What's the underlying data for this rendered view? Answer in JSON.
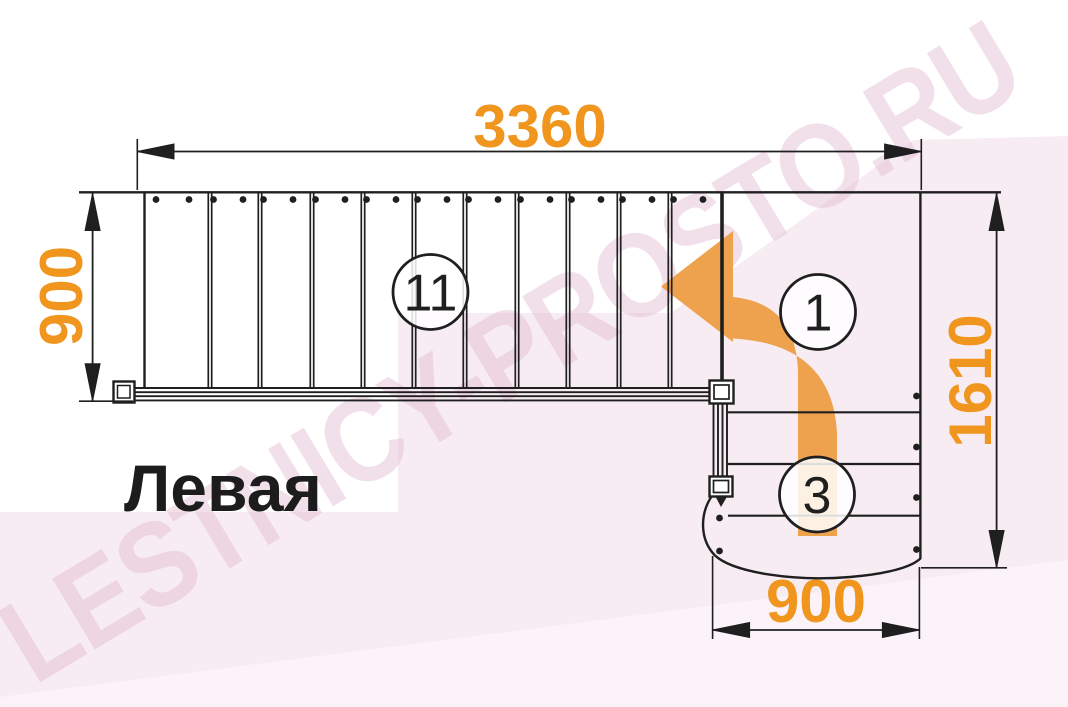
{
  "page": {
    "type_label": "Левая",
    "watermark": "LESTNICY-PROSTO.RU"
  },
  "dimensions": {
    "total_length_mm": "3360",
    "upper_flight_width_mm": "900",
    "total_depth_mm": "1610",
    "lower_flight_width_mm": "900"
  },
  "flight_markers": {
    "upper_steps": "11",
    "turn_step": "1",
    "lower_steps": "3"
  },
  "structure": {
    "upper_tread_count": 11,
    "lower_step_line_count": 3
  },
  "colors": {
    "dimension_orange": "#f0951d",
    "arrow_orange": "#efa24e",
    "line_black": "#1f1f1f",
    "background_pink": "#f8ecf3",
    "watermark_pink": "#dcb0c9"
  }
}
